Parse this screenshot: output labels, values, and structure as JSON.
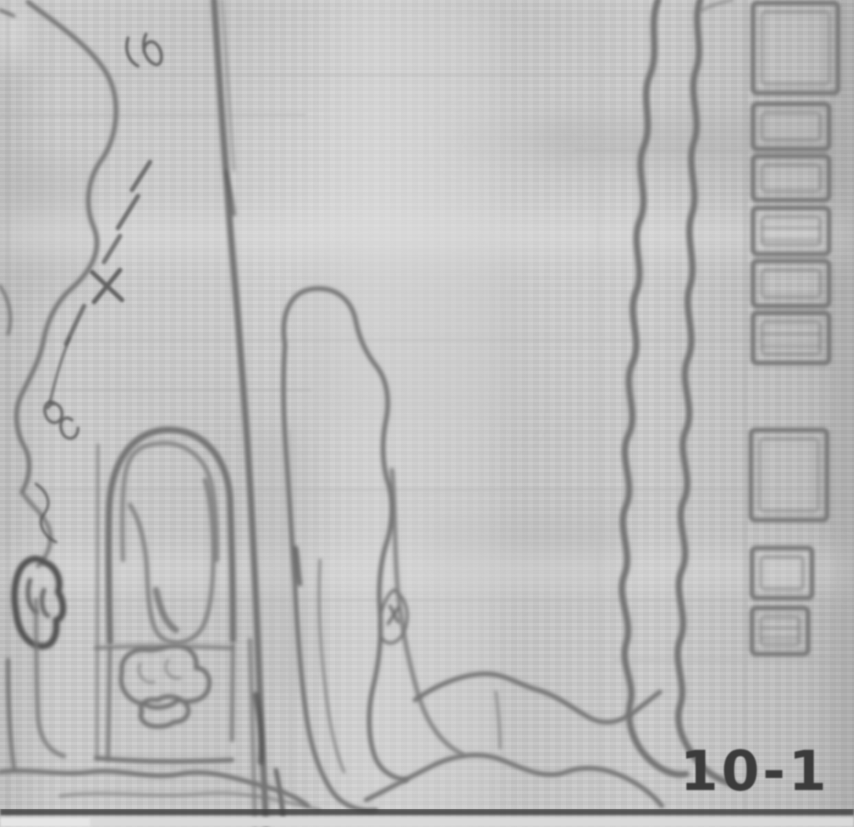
{
  "page": {
    "kind": "scanned hand-drawn field map",
    "sheet_label": "10-1",
    "colors": {
      "paper": "#c9c9c9",
      "pencil": "#757575",
      "pencil_dark": "#525252",
      "grid": "#b0b0b0",
      "rule": "#3f3f3f",
      "label": "#3b3b3b"
    }
  },
  "features": {
    "left_contour": "wavy boundary line with tick and cross marks",
    "central_road": "long vertical road/stream line",
    "middle_lobe": "elongated enclosed land parcel",
    "meander_band": "double wavy stream band running to bottom right",
    "right_stream": "wide meandering vertical stream band",
    "field_plots_count": 9,
    "arch_enclosure": "arched structure over rectangular pond enclosure",
    "pond_blobs_count": 2,
    "bottom_rule": "dark horizontal border line",
    "label_position": "bottom-right"
  }
}
